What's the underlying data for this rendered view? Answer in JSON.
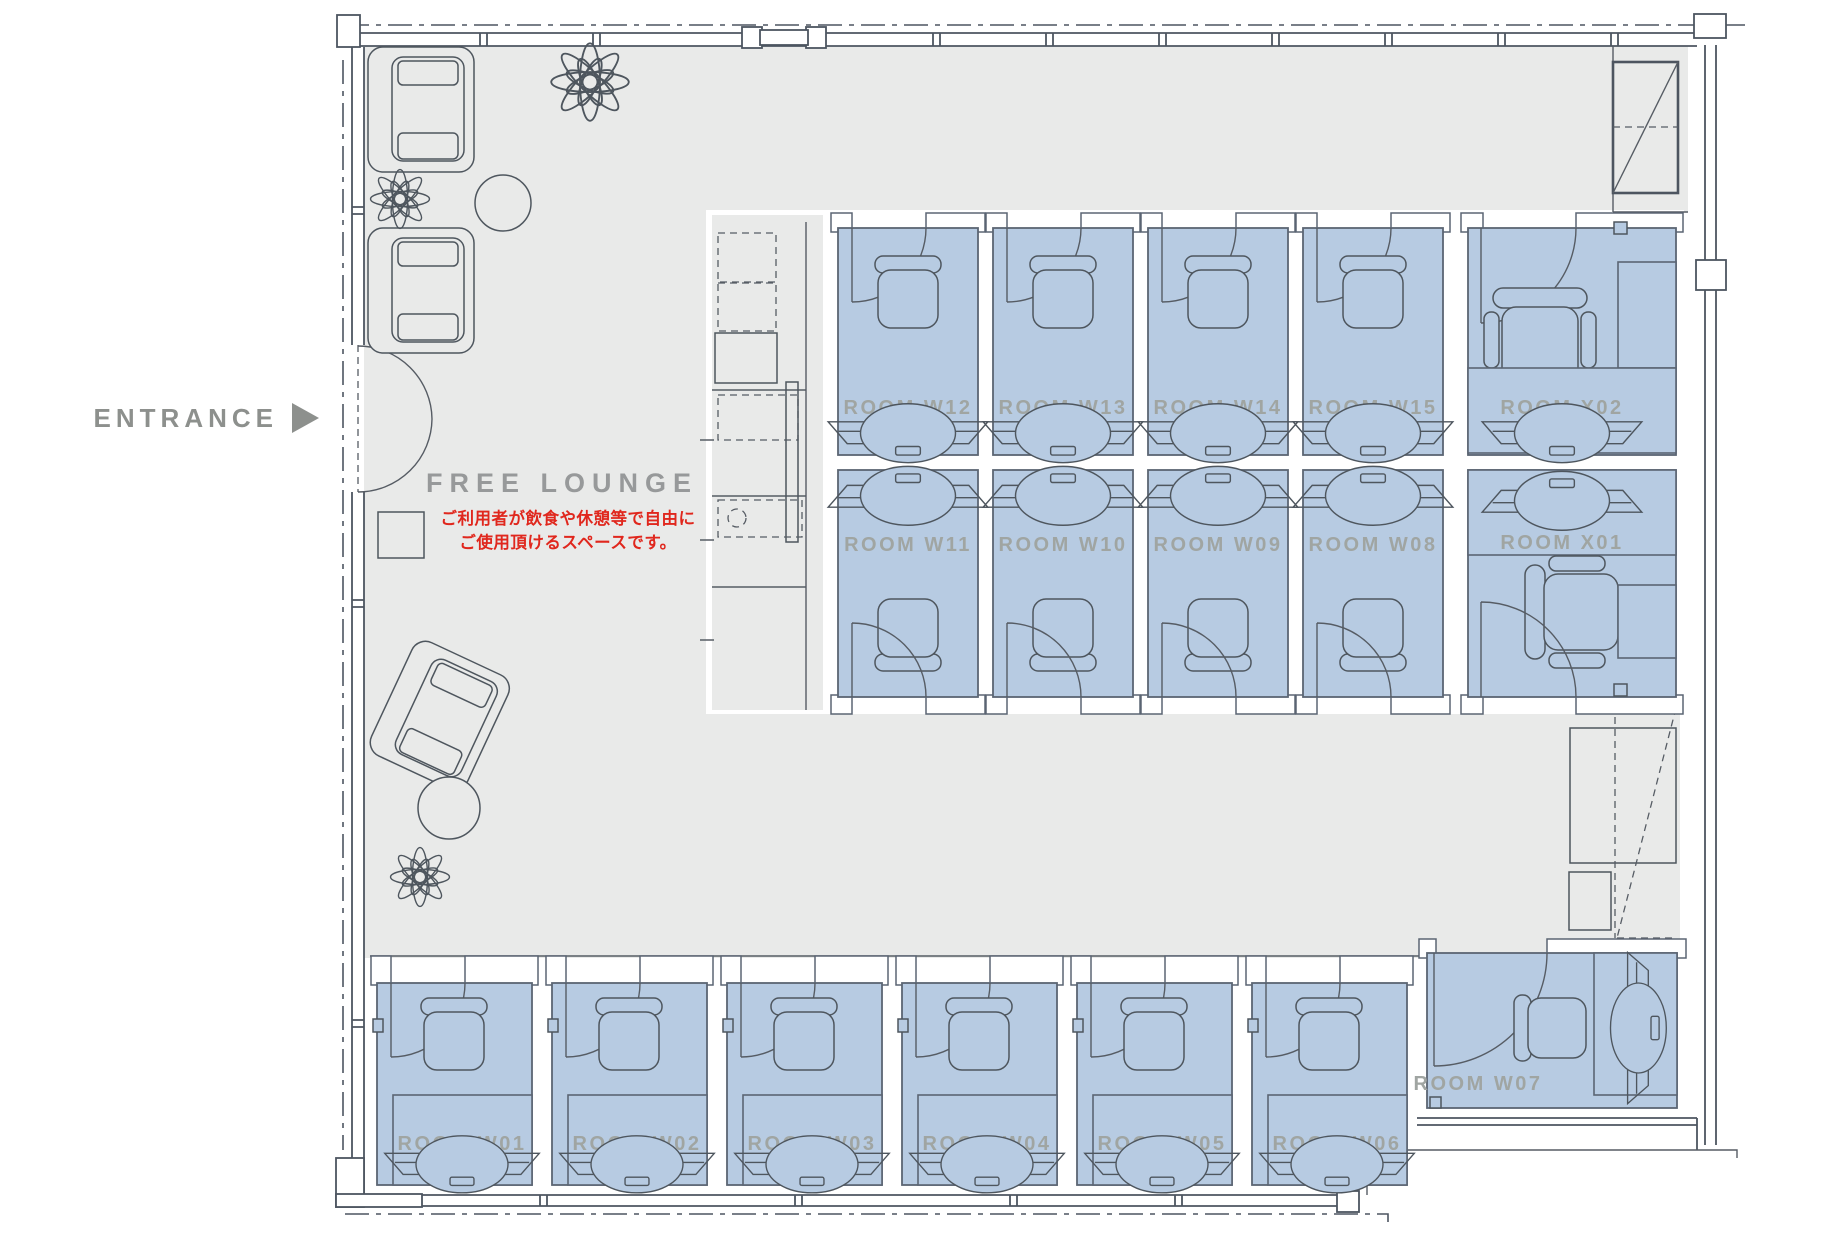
{
  "plan": {
    "entrance_label": "ENTRANCE",
    "lounge_title": "FREE LOUNGE",
    "lounge_note_line1": "ご利用者が飲食や休憩等で自由に",
    "lounge_note_line2": "ご使用頂けるスペースです。",
    "rooms_top": [
      "ROOM W12",
      "ROOM W13",
      "ROOM W14",
      "ROOM W15",
      "ROOM X02"
    ],
    "rooms_middle": [
      "ROOM W11",
      "ROOM W10",
      "ROOM W09",
      "ROOM W08",
      "ROOM X01"
    ],
    "rooms_bottom": [
      "ROOM W01",
      "ROOM W02",
      "ROOM W03",
      "ROOM W04",
      "ROOM W05",
      "ROOM W06"
    ],
    "room_corner": "ROOM W07",
    "colors": {
      "room_fill": "#b7cbe2",
      "floor": "#e9eae9",
      "wall_line": "#4d5560",
      "room_label": "#a0a5a2",
      "note_red": "#e0271d"
    }
  }
}
